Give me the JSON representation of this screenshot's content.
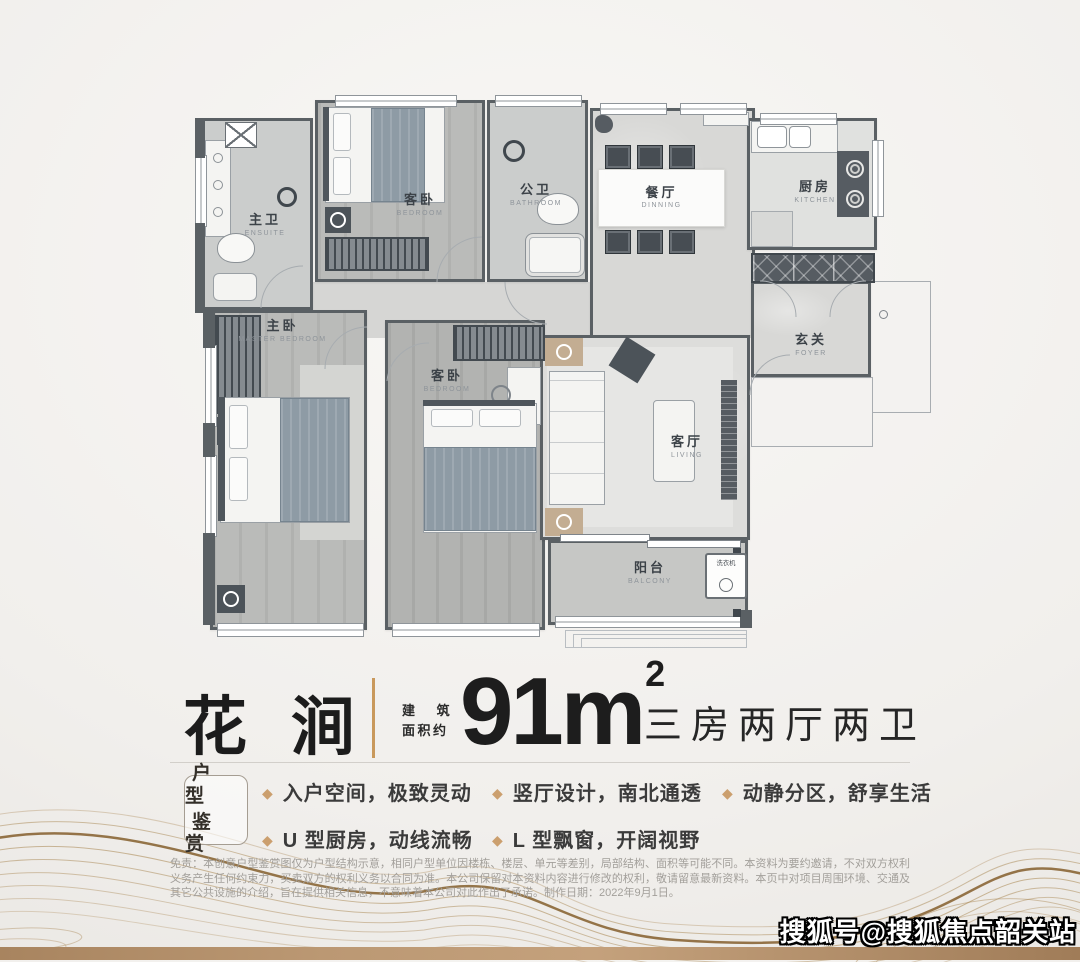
{
  "poster": {
    "title": {
      "name": "花 涧",
      "area_label_line1": "建 筑",
      "area_label_line2": "面积约",
      "area_value": "91m",
      "area_sup": "2",
      "layout": "三房两厅两卫"
    },
    "section": {
      "box_line1": "户 型",
      "box_line2": "鉴 赏"
    },
    "features": [
      "入户空间，极致灵动",
      "竖厅设计，南北通透",
      "动静分区，舒享生活",
      "U 型厨房，动线流畅",
      "L 型飘窗，开阔视野"
    ],
    "disclaimer": "免责：本创意户型鉴赏图仅为户型结构示意，相同户型单位因楼栋、楼层、单元等差别，局部结构、面积等可能不同。本资料为要约邀请，不对双方权利义务产生任何约束力，买卖双方的权利义务以合同为准。本公司保留对本资料内容进行修改的权利，敬请留意最新资料。本页中对项目周围环境、交通及其它公共设施的介绍，旨在提供相关信息，不意味着本公司对此作出了承诺。制作日期：2022年9月1日。",
    "watermark": "搜狐号@搜狐焦点韶关站"
  },
  "plan": {
    "rooms": {
      "ensuite": {
        "zh": "主卫",
        "en": "ENSUITE"
      },
      "bedroom_top": {
        "zh": "客卧",
        "en": "BEDROOM"
      },
      "bathroom": {
        "zh": "公卫",
        "en": "BATHROOM"
      },
      "dining": {
        "zh": "餐厅",
        "en": "DINNING"
      },
      "kitchen": {
        "zh": "厨房",
        "en": "KITCHEN"
      },
      "foyer": {
        "zh": "玄关",
        "en": "FOYER"
      },
      "master": {
        "zh": "主卧",
        "en": "MASTER BEDROOM"
      },
      "bedroom2": {
        "zh": "客卧",
        "en": "BEDROOM"
      },
      "living": {
        "zh": "客厅",
        "en": "LIVING"
      },
      "balcony": {
        "zh": "阳台",
        "en": "BALCONY"
      },
      "washer": {
        "zh": "洗衣机"
      }
    }
  },
  "colors": {
    "accent_gold": "#c9995c",
    "wall": "#5a6064",
    "band": "#b28e68"
  }
}
